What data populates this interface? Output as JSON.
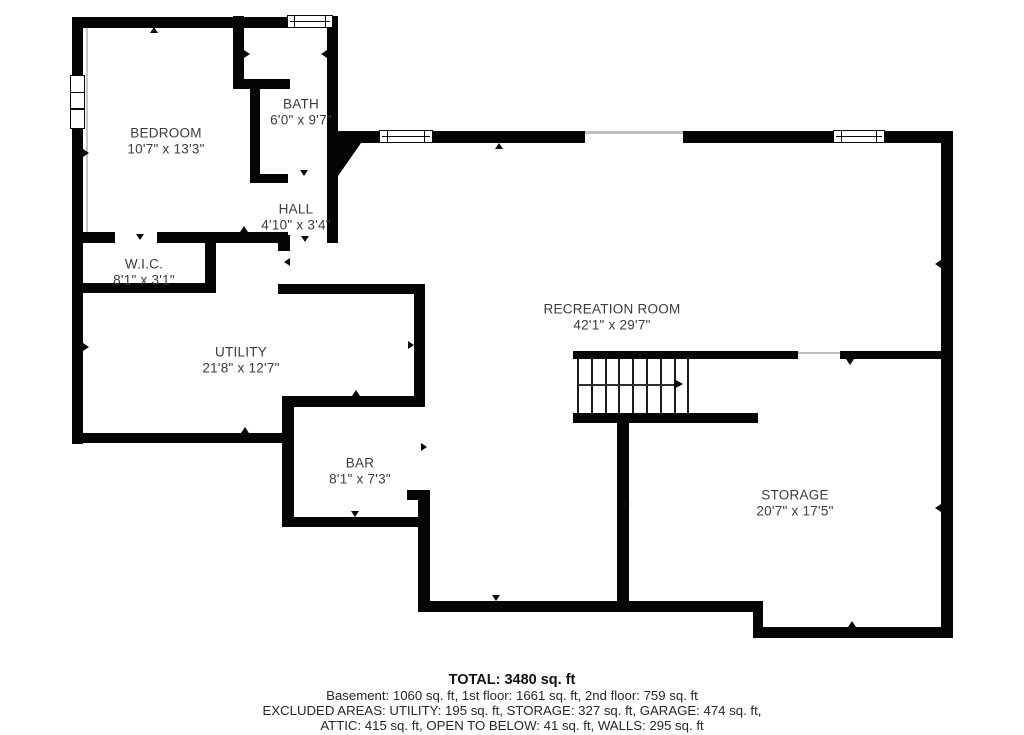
{
  "plan": {
    "type": "basement floor plan",
    "rooms": [
      {
        "name": "BEDROOM",
        "dims": "10'7\" x 13'3\""
      },
      {
        "name": "BATH",
        "dims": "6'0\" x 9'7\""
      },
      {
        "name": "HALL",
        "dims": "4'10\" x 3'4\""
      },
      {
        "name": "W.I.C.",
        "dims": "8'1\" x 3'1\""
      },
      {
        "name": "UTILITY",
        "dims": "21'8\" x 12'7\""
      },
      {
        "name": "BAR",
        "dims": "8'1\" x 7'3\""
      },
      {
        "name": "RECREATION ROOM",
        "dims": "42'1\" x 29'7\""
      },
      {
        "name": "STORAGE",
        "dims": "20'7\" x 17'5\""
      }
    ],
    "stairs": {
      "direction_arrow": "right",
      "treads": 8
    }
  },
  "summary": {
    "total": "TOTAL: 3480 sq. ft",
    "floors": "Basement: 1060 sq. ft, 1st floor: 1661 sq. ft, 2nd floor: 759 sq. ft",
    "excluded1": "EXCLUDED AREAS: UTILITY: 195 sq. ft, STORAGE: 327 sq. ft, GARAGE: 474 sq. ft,",
    "excluded2": "ATTIC: 415 sq. ft, OPEN TO BELOW: 41 sq. ft, WALLS: 295 sq. ft"
  },
  "colors": {
    "wall": "#050505",
    "background": "#ffffff",
    "label_text": "#3b3b3b",
    "summary_text": "#262626",
    "opening_line": "#bfbfbf"
  }
}
